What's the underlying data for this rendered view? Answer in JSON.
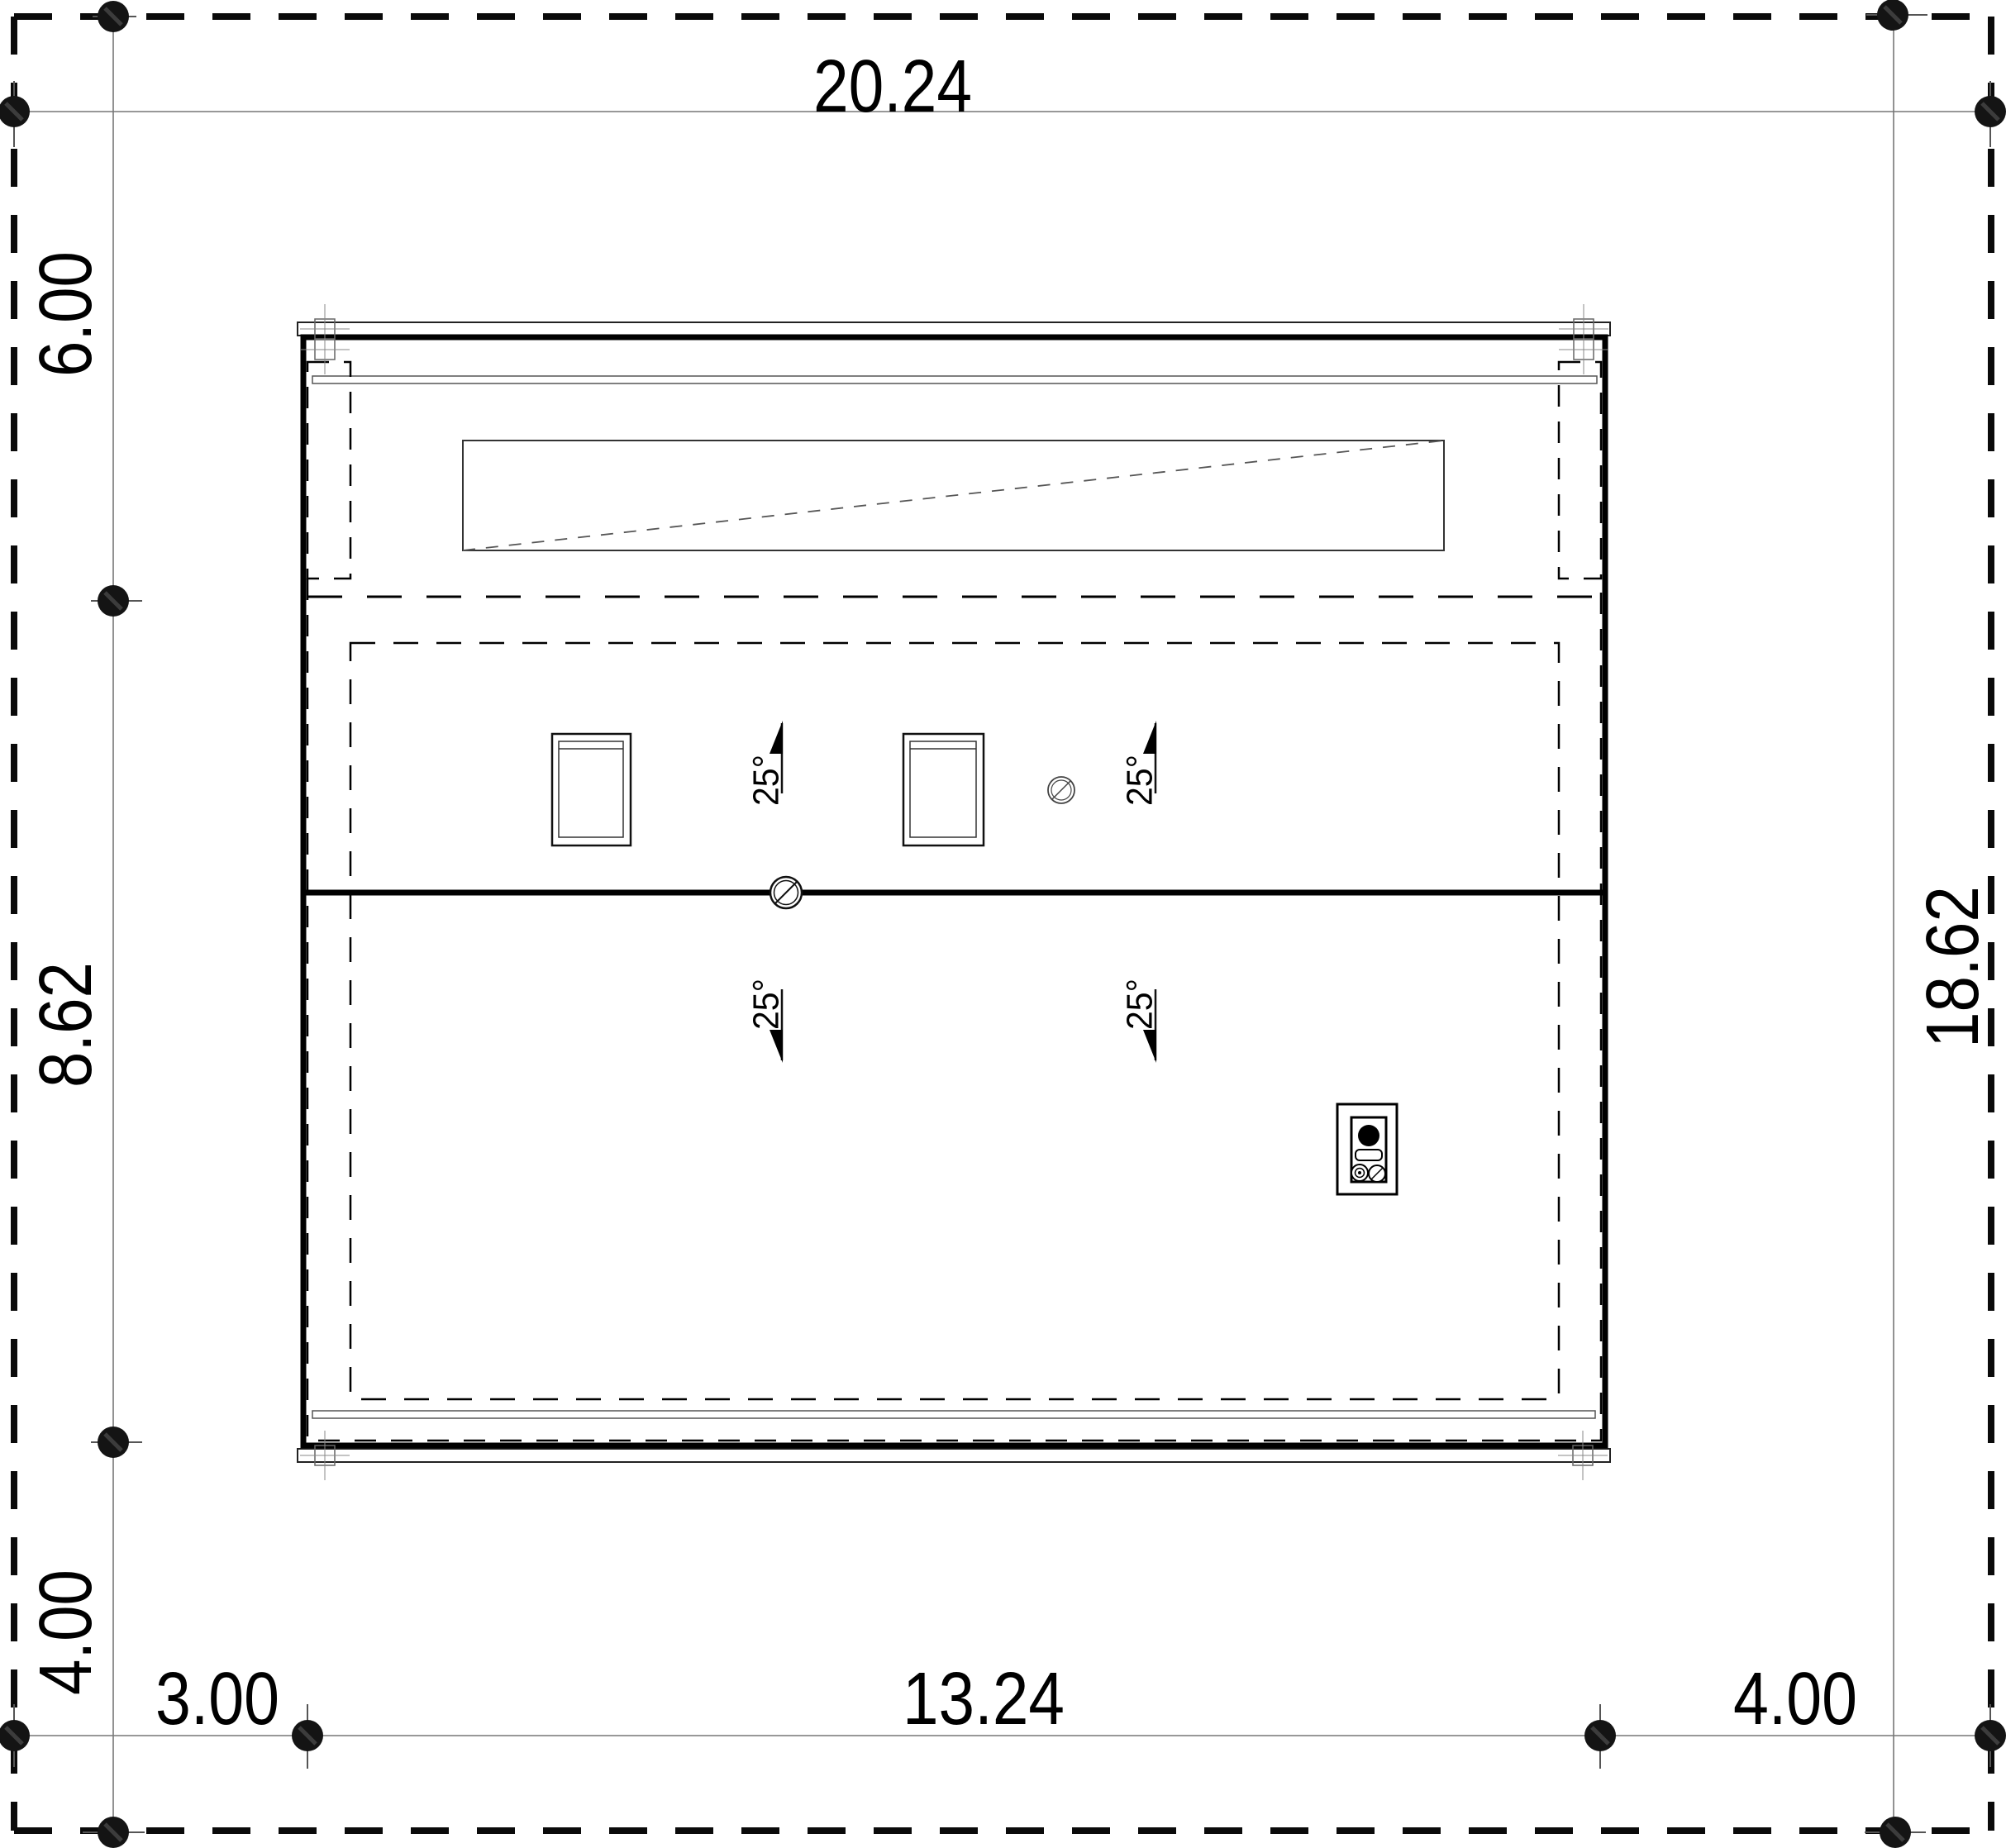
{
  "drawing": {
    "kind": "roof-plan-technical-drawing"
  },
  "dimensions": {
    "overall_width_top": "20.24",
    "left_top": "6.00",
    "left_middle": "8.62",
    "left_bottom": "4.00",
    "right_overall": "18.62",
    "bottom_left": "3.00",
    "bottom_middle": "13.24",
    "bottom_right": "4.00"
  },
  "roof": {
    "slope_angle": "25°"
  },
  "colors": {
    "line_black": "#000000",
    "thin_line_gray": "#777777",
    "background": "#ffffff"
  }
}
